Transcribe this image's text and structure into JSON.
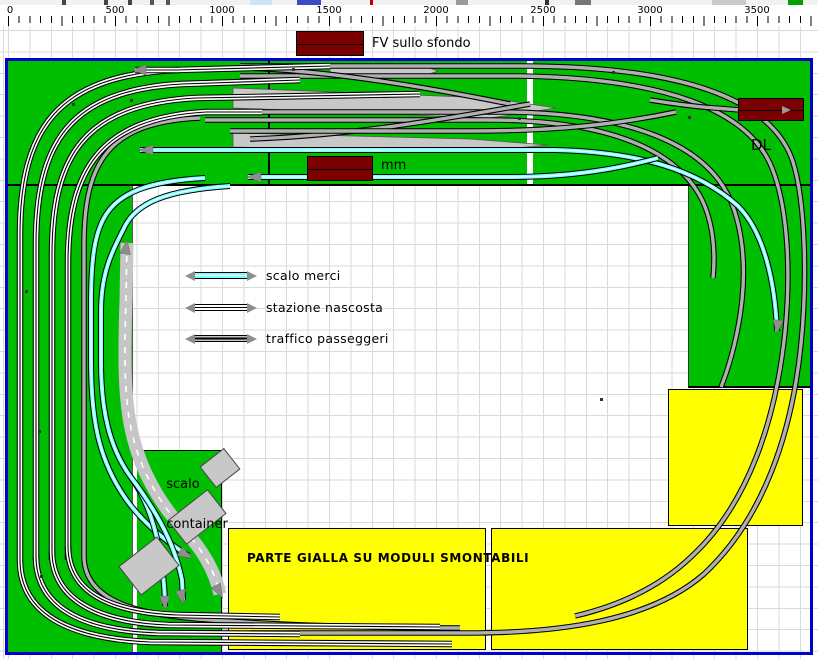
{
  "ruler": {
    "labels": [
      "0",
      "500",
      "1000",
      "1500",
      "2000",
      "2500",
      "3000",
      "3500"
    ]
  },
  "annotations": {
    "fv_label": "FV sullo sfondo",
    "mm_label": "mm",
    "dl_label": "DL",
    "scalo_container_line1": "scalo",
    "scalo_container_line2": "container",
    "parte_gialla": "PARTE GIALLA SU MODULI SMONTABILI"
  },
  "legend": {
    "items": [
      {
        "label": "scalo merci",
        "track_color": "#7FFFFF"
      },
      {
        "label": "stazione nascosta",
        "track_color": "#FFFFFF"
      },
      {
        "label": "traffico passeggeri",
        "track_color": "#B0B0B0"
      }
    ]
  },
  "colors": {
    "baseboard_green": "#00be00",
    "module_yellow": "#ffff00",
    "building_maroon": "#7a0000",
    "track_gray": "#b0b0b0",
    "track_cyan": "#7fffff",
    "track_white": "#ffffff",
    "platform_gray": "#c8c8c8",
    "road_gray": "#c6c6c6",
    "layout_border_blue": "#0000cc",
    "grid_line": "#dadada",
    "arrow_gray": "#8e8e8e"
  }
}
